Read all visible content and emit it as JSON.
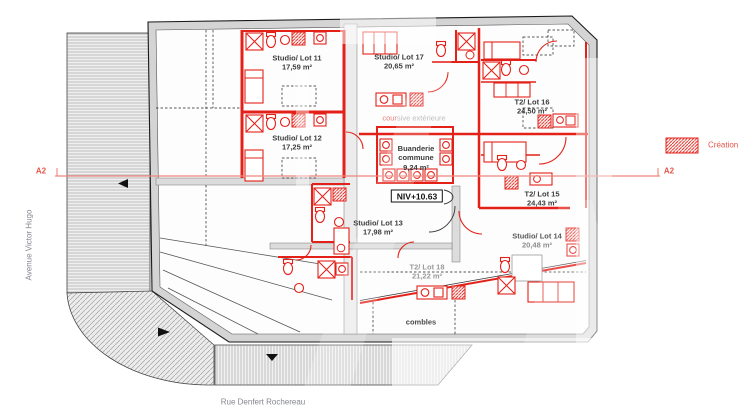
{
  "legend": {
    "creation": "Création"
  },
  "section_marker": {
    "left": "A2",
    "right": "A2"
  },
  "streets": {
    "left_vertical": "Avenue Victor Hugo",
    "bottom": "Rue Denfert Rochereau"
  },
  "level_badge": "NIV+10.63",
  "zones": {
    "coursive_prefix": "cour",
    "coursive_suffix": "sive extérieure",
    "combles": "combles"
  },
  "rooms": [
    {
      "id": "lot-11",
      "name": "Studio/ Lot 11",
      "area": "17,59 m²"
    },
    {
      "id": "lot-12",
      "name": "Studio/ Lot 12",
      "area": "17,25 m²"
    },
    {
      "id": "lot-13",
      "name": "Studio/ Lot 13",
      "area": "17,98 m²"
    },
    {
      "id": "lot-14",
      "name": "Studio/ Lot 14",
      "area": "20,48 m²"
    },
    {
      "id": "lot-15",
      "name": "T2/ Lot 15",
      "area": "24,43 m²"
    },
    {
      "id": "lot-16",
      "name": "T2/ Lot 16",
      "area": "24,50 m²"
    },
    {
      "id": "lot-17",
      "name": "Studio/ Lot 17",
      "area": "20,65 m²"
    },
    {
      "id": "lot-18",
      "name": "T2/ Lot 18",
      "area": "21,22 m²"
    },
    {
      "id": "buanderie",
      "name": "Buanderie commune",
      "area": "9,24 m²"
    }
  ],
  "colors": {
    "creation_red": "#e32119",
    "section_red": "#f0867e",
    "label_red": "#e8554b",
    "wall_gray": "#d4d4d4",
    "text_dark": "#3c3c3c",
    "text_gray": "#9a9a9a"
  }
}
